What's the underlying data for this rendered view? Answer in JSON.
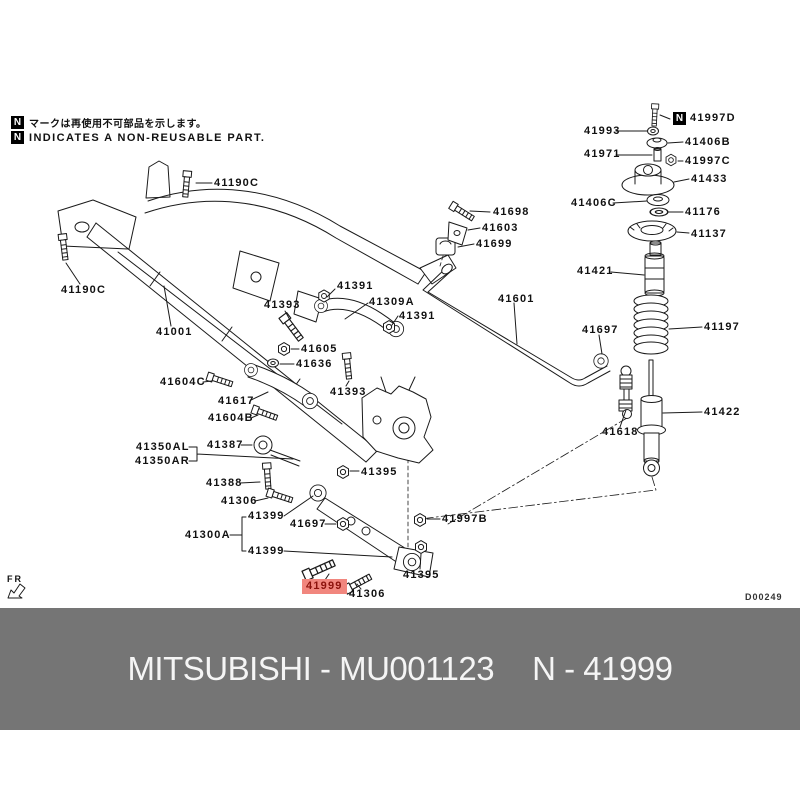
{
  "note": {
    "icon": "N",
    "line1": "マークは再使用不可部品を示します。",
    "line2": "INDICATES A NON-REUSABLE PART."
  },
  "diagram": {
    "drawing_code": "D00249",
    "fr_label": "FR",
    "highlighted_part": "41999",
    "highlight_bg": "#f1867e",
    "highlight_fg": "#8c120c",
    "line_color": "#1a1a1a",
    "labels": [
      {
        "text": "41190C",
        "x": 214,
        "y": 178
      },
      {
        "text": "41190C",
        "x": 61,
        "y": 285
      },
      {
        "text": "41001",
        "x": 156,
        "y": 327
      },
      {
        "text": "41393",
        "x": 264,
        "y": 300
      },
      {
        "text": "41391",
        "x": 337,
        "y": 281
      },
      {
        "text": "41309A",
        "x": 369,
        "y": 297
      },
      {
        "text": "41391",
        "x": 399,
        "y": 311
      },
      {
        "text": "41605",
        "x": 301,
        "y": 344
      },
      {
        "text": "41636",
        "x": 296,
        "y": 359
      },
      {
        "text": "41393",
        "x": 330,
        "y": 387
      },
      {
        "text": "41604C",
        "x": 160,
        "y": 377
      },
      {
        "text": "41617",
        "x": 218,
        "y": 396
      },
      {
        "text": "41604B",
        "x": 208,
        "y": 413
      },
      {
        "text": "41350AL",
        "x": 136,
        "y": 442
      },
      {
        "text": "41350AR",
        "x": 135,
        "y": 456
      },
      {
        "text": "41387",
        "x": 207,
        "y": 440
      },
      {
        "text": "41388",
        "x": 206,
        "y": 478
      },
      {
        "text": "41306",
        "x": 221,
        "y": 496
      },
      {
        "text": "41399",
        "x": 248,
        "y": 511
      },
      {
        "text": "41300A",
        "x": 185,
        "y": 530
      },
      {
        "text": "41399",
        "x": 248,
        "y": 546
      },
      {
        "text": "41697",
        "x": 290,
        "y": 519
      },
      {
        "text": "41395",
        "x": 361,
        "y": 467
      },
      {
        "text": "41997B",
        "x": 442,
        "y": 514
      },
      {
        "text": "41395",
        "x": 403,
        "y": 570
      },
      {
        "text": "41999",
        "x": 306,
        "y": 581,
        "highlight": true
      },
      {
        "text": "41306",
        "x": 349,
        "y": 589
      },
      {
        "text": "41698",
        "x": 493,
        "y": 207
      },
      {
        "text": "41603",
        "x": 482,
        "y": 223
      },
      {
        "text": "41699",
        "x": 476,
        "y": 239
      },
      {
        "text": "41601",
        "x": 498,
        "y": 294
      },
      {
        "text": "41697",
        "x": 582,
        "y": 325
      },
      {
        "text": "41618",
        "x": 602,
        "y": 427
      },
      {
        "text": "41422",
        "x": 704,
        "y": 407
      },
      {
        "text": "41197",
        "x": 704,
        "y": 322
      },
      {
        "text": "41421",
        "x": 577,
        "y": 266
      },
      {
        "text": "41993",
        "x": 584,
        "y": 126
      },
      {
        "text": "41997D",
        "x": 690,
        "y": 113
      },
      {
        "text": "41406B",
        "x": 685,
        "y": 137
      },
      {
        "text": "41971",
        "x": 584,
        "y": 149
      },
      {
        "text": "41997C",
        "x": 685,
        "y": 156
      },
      {
        "text": "41433",
        "x": 691,
        "y": 174
      },
      {
        "text": "41406C",
        "x": 571,
        "y": 198
      },
      {
        "text": "41176",
        "x": 685,
        "y": 207
      },
      {
        "text": "41137",
        "x": 691,
        "y": 229
      }
    ]
  },
  "footer": {
    "bg": "#757575",
    "fg": "#f5f5f5",
    "brand_part": "MITSUBISHI - MU001123",
    "part_ref": "N - 41999"
  }
}
